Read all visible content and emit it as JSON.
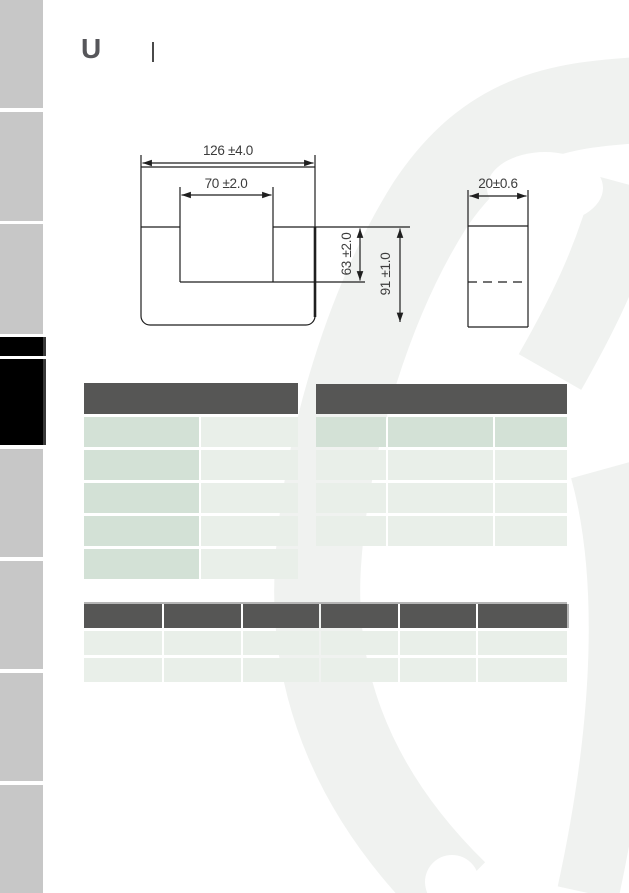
{
  "document": {
    "series_letter": "U",
    "header_divider_present": true
  },
  "drawing": {
    "front_view": {
      "overall_width_dim": "126 ±4.0",
      "window_width_dim": "70 ±2.0",
      "window_depth_dim": "63 ±2.0",
      "overall_height_dim": "91 ±1.0"
    },
    "side_view": {
      "thickness_dim": "20±0.6"
    }
  },
  "tables": {
    "left": {
      "header_text": "",
      "column_count": 2,
      "row_count": 5,
      "rows": [
        [
          "",
          ""
        ],
        [
          "",
          ""
        ],
        [
          "",
          ""
        ],
        [
          "",
          ""
        ],
        [
          "",
          ""
        ]
      ]
    },
    "right": {
      "header_text": "",
      "column_count": 3,
      "row_count": 4,
      "rows": [
        [
          "",
          "",
          ""
        ],
        [
          "",
          "",
          ""
        ],
        [
          "",
          "",
          ""
        ],
        [
          "",
          "",
          ""
        ]
      ]
    },
    "bottom": {
      "header_cells": [
        "",
        "",
        "",
        "",
        "",
        ""
      ],
      "column_count": 6,
      "row_count": 2,
      "rows": [
        [
          "",
          "",
          "",
          "",
          "",
          ""
        ],
        [
          "",
          "",
          "",
          "",
          "",
          ""
        ]
      ]
    }
  },
  "sidebar": {
    "tab_count": 9,
    "active_tab_indices": [
      3,
      4
    ]
  },
  "colors": {
    "table_header": "#565655",
    "cell_dark": "#d3e1d6",
    "cell_light": "#e9efe9",
    "sidebar_gray": "#c7c7c7",
    "sidebar_active": "#000000",
    "watermark": "#f0f2f0",
    "drawing_line": "#1f1f1f",
    "logo_text": "#56565a"
  }
}
